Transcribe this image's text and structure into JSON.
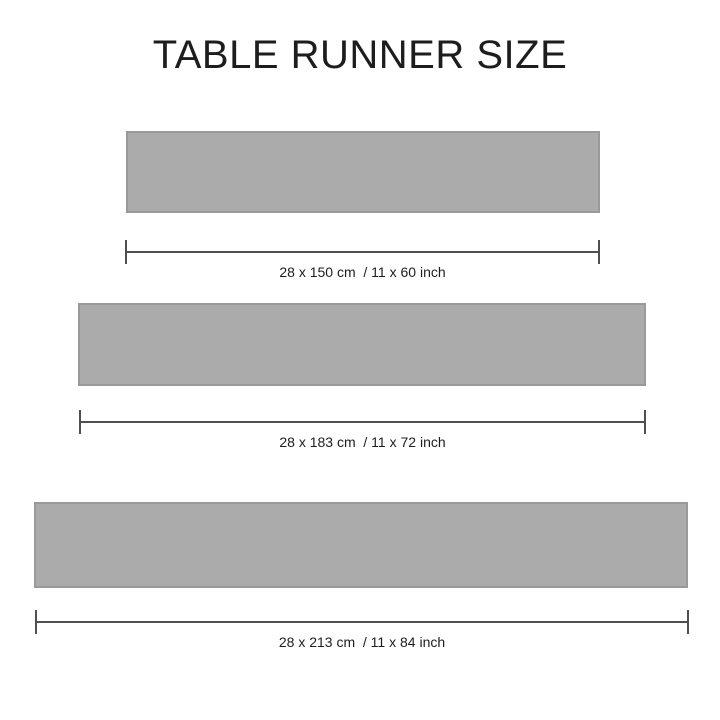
{
  "title": "TABLE RUNNER SIZE",
  "colors": {
    "background": "#ffffff",
    "runner_fill": "#ababab",
    "runner_border": "#9a9a9a",
    "dimension_line": "#4f4f4f",
    "text": "#1d1d1d"
  },
  "runners": [
    {
      "size_cm": "28 x 150 cm",
      "size_inch": "11 x 60 inch",
      "label": "28 x 150 cm  / 11 x 60 inch"
    },
    {
      "size_cm": "28 x 183 cm",
      "size_inch": "11 x 72 inch",
      "label": "28 x 183 cm  / 11 x 72 inch"
    },
    {
      "size_cm": "28 x 213 cm",
      "size_inch": "11 x 84 inch",
      "label": "28 x 213 cm  / 11 x 84 inch"
    }
  ]
}
